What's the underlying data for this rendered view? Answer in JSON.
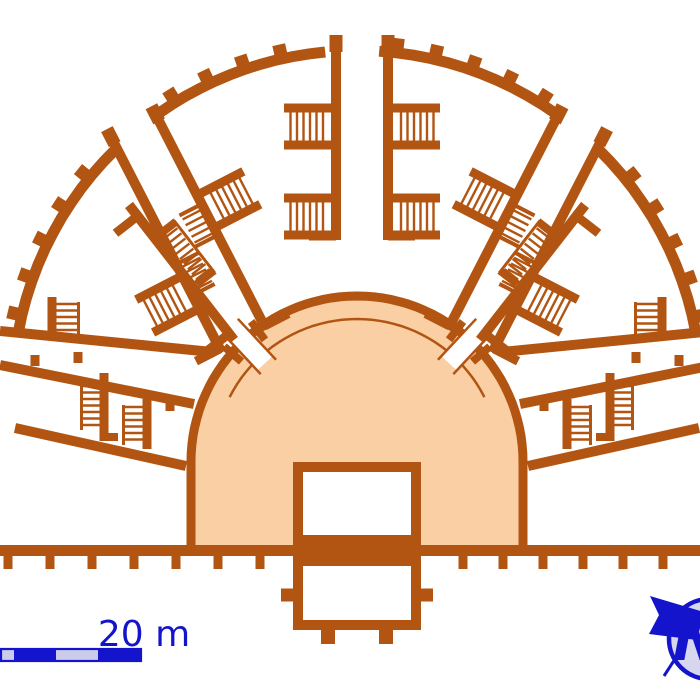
{
  "figure": {
    "subject": "roman-theatre-ground-plan"
  },
  "colors": {
    "wall_brown": "#B25512",
    "orchestra_fill": "#FBCFA4",
    "background": "#FFFFFF",
    "accent_blue": "#1414CC",
    "scale_alt_fill": "#CBCBEA",
    "compass_fill": "#D6D6EF",
    "white": "#FFFFFF"
  },
  "scale_bar": {
    "label": "20 m",
    "x": 1,
    "y": 649,
    "width": 140,
    "height": 12,
    "segments": [
      {
        "x0": 1,
        "x1": 14,
        "color": "#CBCBEA"
      },
      {
        "x0": 14,
        "x1": 56,
        "color": "#1414CC"
      },
      {
        "x0": 56,
        "x1": 98,
        "color": "#CBCBEA"
      },
      {
        "x0": 98,
        "x1": 140,
        "color": "#1414CC"
      }
    ],
    "label_x": 144,
    "label_y": 646,
    "label_size": 36
  },
  "north_arrow": {
    "label": "N",
    "circle": {
      "cx": 709,
      "cy": 639,
      "r": 40,
      "stroke_w": 4.5
    },
    "flag": [
      [
        704,
        612
      ],
      [
        650,
        596
      ],
      [
        659,
        615
      ],
      [
        649,
        634
      ],
      [
        697,
        640
      ]
    ],
    "shaft": [
      664,
      676,
      717,
      594
    ],
    "label_x": 697,
    "label_y": 660,
    "label_size": 58
  },
  "plan": {
    "canvas": {
      "w": 700,
      "h": 700
    },
    "orchestra": {
      "cx": 357,
      "cy": 462,
      "r_outer": 166,
      "r_inner": 143,
      "wall": 9,
      "inner_arc_span": [
        27,
        153
      ],
      "base_y": 545,
      "corridor_angles": [
        133,
        47
      ],
      "corridor_r": [
        130,
        186
      ],
      "corridor_halfwidth": 10.5,
      "stub_angles": [
        127,
        139,
        53,
        41
      ],
      "stub_r": [
        153,
        176
      ],
      "stub_w": 8
    },
    "cavea": {
      "cx": 357,
      "cy": 395,
      "r": 344.5,
      "wall": 11,
      "segments": [
        [
          10.5,
          45.6
        ],
        [
          54.6,
          86.3
        ],
        [
          95.3,
          125.4
        ],
        [
          134.4,
          169.5
        ]
      ],
      "buttress": {
        "r0": 343,
        "r1": 359,
        "w": 13,
        "from": 13,
        "to": 168,
        "step": 6.4,
        "skip": [
          50.1,
          90.8,
          129.9
        ],
        "skip_tol": 5.6
      }
    },
    "aisles": [
      {
        "out": [
          362,
          50
        ],
        "in": [
          362,
          240
        ],
        "halfgap": 26,
        "wall": 10,
        "flank": [
          {
            "side": 1,
            "t": [
              58,
              95
            ]
          },
          {
            "side": -1,
            "t": [
              58,
              95
            ]
          },
          {
            "side": 1,
            "t": [
              148,
              185
            ]
          },
          {
            "side": -1,
            "t": [
              148,
              185
            ]
          }
        ],
        "bands": []
      },
      {
        "out": [
          136,
          131
        ],
        "in": [
          244,
          341
        ],
        "halfgap": 25,
        "wall": 10,
        "flank": [
          {
            "side": -1,
            "t": [
              85,
              122
            ]
          },
          {
            "side": 1,
            "t": [
              150,
              187
            ]
          }
        ],
        "bands": [
          {
            "t": [
              95,
              130
            ],
            "o": [
              -25,
              0
            ]
          },
          {
            "t": [
              137,
              172
            ],
            "o": [
              0,
              25
            ]
          }
        ]
      },
      {
        "out": [
          578,
          131
        ],
        "in": [
          470,
          341
        ],
        "halfgap": 25,
        "wall": 10,
        "flank": [
          {
            "side": 1,
            "t": [
              85,
              122
            ]
          },
          {
            "side": -1,
            "t": [
              150,
              187
            ]
          }
        ],
        "bands": [
          {
            "t": [
              95,
              130
            ],
            "o": [
              0,
              25
            ]
          },
          {
            "t": [
              137,
              172
            ],
            "o": [
              -25,
              0
            ]
          }
        ]
      }
    ],
    "companions": [
      {
        "p": [
          129,
          205
        ],
        "q": [
          234,
          340
        ],
        "stair_side": -1
      },
      {
        "p": [
          585,
          205
        ],
        "q": [
          480,
          340
        ],
        "stair_side": 1
      }
    ],
    "walls": [
      [
        0,
        331,
        212,
        352,
        10
      ],
      [
        714,
        331,
        502,
        352,
        10
      ],
      [
        0,
        365,
        194,
        404,
        10
      ],
      [
        714,
        365,
        520,
        404,
        10
      ],
      [
        15,
        428,
        186,
        466,
        10
      ],
      [
        699,
        428,
        528,
        466,
        10
      ],
      [
        52,
        297,
        52,
        340,
        9
      ],
      [
        662,
        297,
        662,
        340,
        9
      ],
      [
        104,
        373,
        104,
        441,
        9
      ],
      [
        610,
        373,
        610,
        441,
        9
      ],
      [
        147,
        399,
        147,
        449,
        9
      ],
      [
        567,
        399,
        567,
        449,
        9
      ],
      [
        78,
        352,
        78,
        363,
        9
      ],
      [
        636,
        352,
        636,
        363,
        9
      ],
      [
        35,
        355,
        35,
        366,
        9
      ],
      [
        679,
        355,
        679,
        366,
        9
      ],
      [
        170,
        400,
        170,
        411,
        9
      ],
      [
        544,
        400,
        544,
        411,
        9
      ],
      [
        104,
        437,
        118,
        437,
        8
      ],
      [
        610,
        437,
        596,
        437,
        8
      ]
    ],
    "stairs": [
      {
        "x": [
          56,
          77
        ],
        "y": [
          304,
          337
        ],
        "b": 78.5
      },
      {
        "x": [
          83,
          102
        ],
        "y": [
          386,
          428
        ],
        "b": 81.5
      },
      {
        "x": [
          125,
          145
        ],
        "y": [
          407,
          443
        ],
        "b": 123.5
      },
      {
        "x": [
          637,
          658
        ],
        "y": [
          304,
          337
        ],
        "b": 635.5
      },
      {
        "x": [
          612,
          631
        ],
        "y": [
          386,
          428
        ],
        "b": 632.5
      },
      {
        "x": [
          569,
          589
        ],
        "y": [
          407,
          443
        ],
        "b": 590.5
      }
    ],
    "baseline": {
      "y": 550.5,
      "h": 11,
      "tick_y0": 556,
      "tick_y1": 569,
      "tick_w": 9,
      "ticks": [
        8,
        50,
        92,
        134,
        176,
        218,
        260,
        463,
        503,
        543,
        583,
        623,
        663
      ]
    },
    "stage": {
      "upper": [
        293,
        462,
        128,
        83
      ],
      "lower": [
        293,
        556,
        128,
        74
      ],
      "wall": 10,
      "side_stubs": [
        [
          281,
          595,
          298,
          595
        ],
        [
          416,
          595,
          433,
          595
        ]
      ],
      "bottom_stubs": [
        [
          328,
          624,
          328,
          644
        ],
        [
          386,
          624,
          386,
          644
        ]
      ]
    }
  }
}
